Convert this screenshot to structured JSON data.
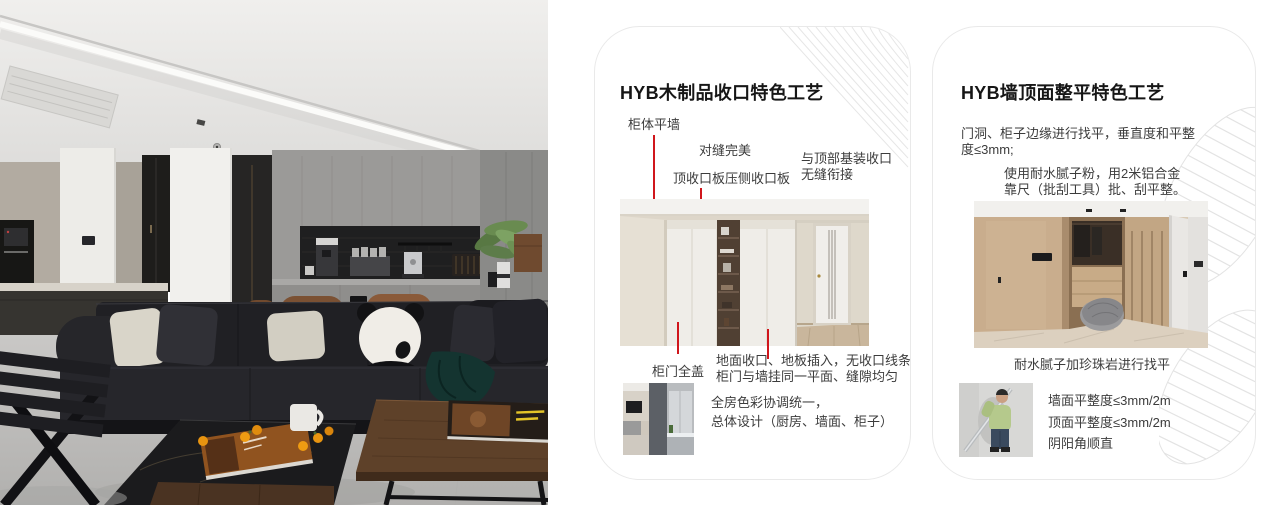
{
  "colors": {
    "accent_red": "#d0161c",
    "card_border": "#e9e9e9",
    "pattern_gray": "#e4e4e4",
    "title_color": "#161616",
    "body_color": "#3c3c3c"
  },
  "left_photo": {
    "description_name": "living-room-photo"
  },
  "cards": [
    {
      "title": "HYB木制品收口特色工艺",
      "callouts": {
        "cabinet_flush_wall": "柜体平墙",
        "perfect_seam": "对缝完美",
        "top_board": "顶收口板压侧收口板",
        "top_joint_l1": "与顶部基装收口",
        "top_joint_l2": "无缝衔接",
        "door_full_cover": "柜门全盖"
      },
      "notes": [
        "地面收口、地板插入，无收口线条",
        "柜门与墙挂同一平面、缝隙均匀"
      ],
      "summary": [
        "全房色彩协调统一，",
        "总体设计（厨房、墙面、柜子）"
      ]
    },
    {
      "title": "HYB墙顶面整平特色工艺",
      "para1": [
        "门洞、柜子边缘进行找平，垂直度和平整",
        "度≤3mm;"
      ],
      "para2": [
        "使用耐水腻子粉，用2米铝合金",
        "靠尺（批刮工具）批、刮平整。"
      ],
      "caption": "耐水腻子加珍珠岩进行找平",
      "specs": [
        "墙面平整度≤3mm/2m",
        "顶面平整度≤3mm/2m",
        "阴阳角顺直"
      ]
    }
  ]
}
